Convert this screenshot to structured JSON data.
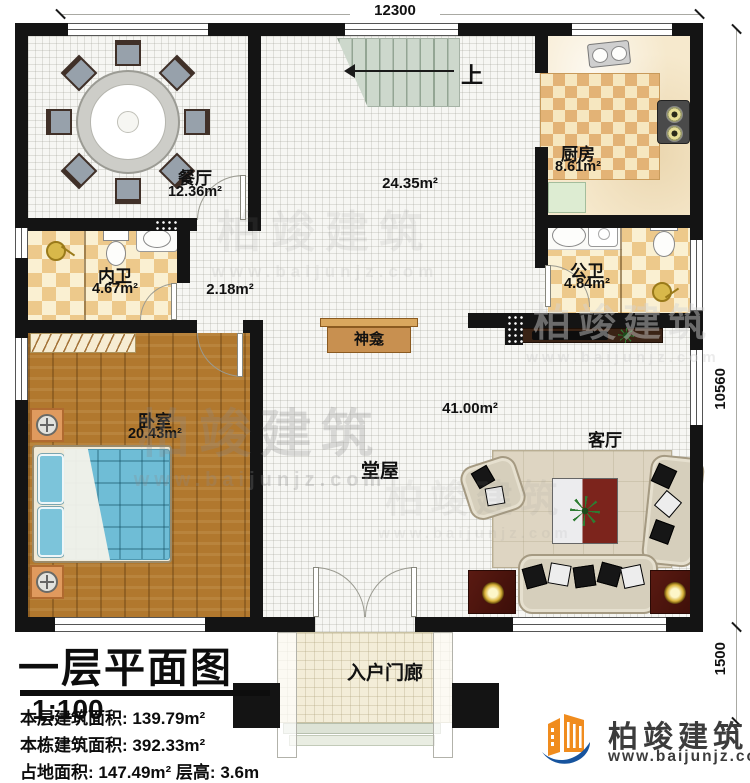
{
  "plan_title": {
    "text": "一层平面图",
    "scale": "1:100"
  },
  "title_block": {
    "line1_label": "本层建筑面积:",
    "line1_value": "139.79m²",
    "line2_label": "本栋建筑面积:",
    "line2_value": "392.33m²",
    "line3_label": "占地面积:",
    "line3_value": "147.49m²",
    "line3_label2": "层高:",
    "line3_value2": "3.6m"
  },
  "rooms": {
    "dining": {
      "name": "餐厅",
      "area": "12.36m²"
    },
    "kitchen": {
      "name": "厨房",
      "area": "8.61m²"
    },
    "inner_bath": {
      "name": "内卫",
      "area": "4.67m²"
    },
    "public_bath": {
      "name": "公卫",
      "area": "4.84m²"
    },
    "bedroom": {
      "name": "卧室",
      "area": "20.43m²"
    },
    "hall": {
      "name": "堂屋",
      "area": "41.00m²",
      "stair_zone_area": "24.35m²",
      "corridor_area": "2.18m²"
    },
    "living": {
      "name": "客厅"
    },
    "porch": {
      "name": "入户门廊"
    },
    "shrine": {
      "name": "神龛"
    }
  },
  "stairs": {
    "direction_label": "上"
  },
  "dimensions": {
    "top_width": "12300",
    "right_height": "10560",
    "porch_depth": "1500"
  },
  "brand": {
    "name": "柏竣建筑",
    "url": "www.baijunjz.com"
  }
}
